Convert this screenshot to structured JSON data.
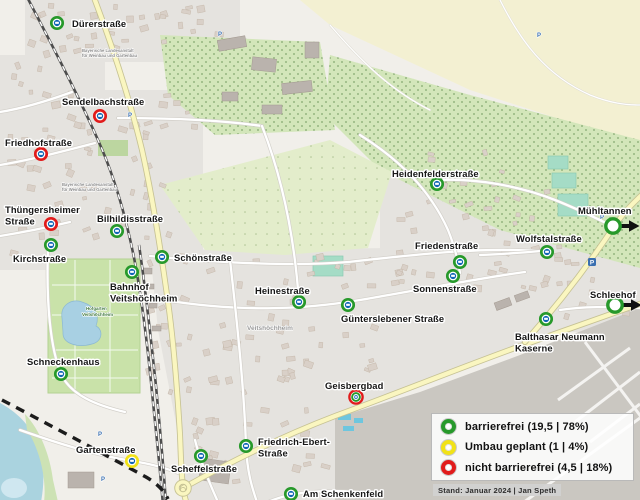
{
  "legend": {
    "items": [
      {
        "key": "barrierefrei",
        "label": "barrierefrei (19,5 | 78%)",
        "color": "#27992b"
      },
      {
        "key": "umbau_geplant",
        "label": "Umbau geplant (1 | 4%)",
        "color": "#f1e217"
      },
      {
        "key": "nicht_barrierefrei",
        "label": "nicht barrierefrei (4,5 | 18%)",
        "color": "#e11b1b"
      }
    ],
    "footnote": "Stand: Januar 2024 | Jan Speth"
  },
  "colors": {
    "barrierefrei": "#27992b",
    "umbau_geplant": "#f1e217",
    "nicht_barrierefrei": "#e11b1b",
    "bus_core": "#1065b5",
    "arrow": "#111111"
  },
  "map": {
    "stops": [
      {
        "id": "duererstrasse",
        "lines": [
          "Dürerstraße"
        ],
        "status": "barrierefrei",
        "x": 57,
        "y": 23,
        "lx": 72,
        "ly": 27
      },
      {
        "id": "sendelbachstrasse",
        "lines": [
          "Sendelbachstraße"
        ],
        "status": "nicht_barrierefrei",
        "x": 100,
        "y": 116,
        "lx": 62,
        "ly": 105
      },
      {
        "id": "friedhofstrasse",
        "lines": [
          "Friedhofstraße"
        ],
        "status": "nicht_barrierefrei",
        "x": 41,
        "y": 154,
        "lx": 5,
        "ly": 146
      },
      {
        "id": "thuengersheimer-strasse",
        "lines": [
          "Thüngersheimer",
          "Straße"
        ],
        "status": "nicht_barrierefrei",
        "x": 51,
        "y": 224,
        "lx": 5,
        "ly": 213
      },
      {
        "id": "bilhildisstrasse",
        "lines": [
          "Bilhildisstraße"
        ],
        "status": "barrierefrei",
        "x": 117,
        "y": 231,
        "lx": 97,
        "ly": 222
      },
      {
        "id": "kirchstrasse",
        "lines": [
          "Kirchstraße"
        ],
        "status": "barrierefrei",
        "x": 51,
        "y": 245,
        "lx": 13,
        "ly": 262
      },
      {
        "id": "schoenstrasse",
        "lines": [
          "Schönstraße"
        ],
        "status": "barrierefrei",
        "x": 162,
        "y": 257,
        "lx": 174,
        "ly": 261
      },
      {
        "id": "bahnhof-veitshoechheim",
        "lines": [
          "Bahnhof",
          "Veitshöchheim"
        ],
        "status": "barrierefrei",
        "x": 132,
        "y": 272,
        "lx": 110,
        "ly": 290
      },
      {
        "id": "heinestrasse",
        "lines": [
          "Heinestraße"
        ],
        "status": "barrierefrei",
        "x": 299,
        "y": 302,
        "lx": 255,
        "ly": 294
      },
      {
        "id": "schneckenhaus",
        "lines": [
          "Schneckenhaus"
        ],
        "status": "barrierefrei",
        "x": 61,
        "y": 374,
        "lx": 27,
        "ly": 365
      },
      {
        "id": "gartenstrasse",
        "lines": [
          "Gartenstraße"
        ],
        "status": "umbau_geplant",
        "x": 132,
        "y": 461,
        "lx": 76,
        "ly": 453
      },
      {
        "id": "scheffelstrasse",
        "lines": [
          "Scheffelstraße"
        ],
        "status": "barrierefrei",
        "x": 201,
        "y": 456,
        "lx": 171,
        "ly": 472
      },
      {
        "id": "friedrich-ebert-strasse",
        "lines": [
          "Friedrich-Ebert-",
          "Straße"
        ],
        "status": "barrierefrei",
        "x": 246,
        "y": 446,
        "lx": 258,
        "ly": 445
      },
      {
        "id": "am-schenkenfeld",
        "lines": [
          "Am Schenkenfeld"
        ],
        "status": "barrierefrei",
        "x": 291,
        "y": 494,
        "lx": 303,
        "ly": 497
      },
      {
        "id": "geisbergbad",
        "lines": [
          "Geisbergbad"
        ],
        "status": "teilweise_barrierefrei",
        "x": 356,
        "y": 397,
        "lx": 325,
        "ly": 389
      },
      {
        "id": "guenterslebener-strasse",
        "lines": [
          "Günterslebener Straße"
        ],
        "status": "barrierefrei",
        "x": 348,
        "y": 305,
        "lx": 341,
        "ly": 322
      },
      {
        "id": "sonnenstrasse",
        "lines": [
          "Sonnenstraße"
        ],
        "status": "barrierefrei",
        "x": 453,
        "y": 276,
        "lx": 413,
        "ly": 292
      },
      {
        "id": "friedenstrasse",
        "lines": [
          "Friedenstraße"
        ],
        "status": "barrierefrei",
        "x": 460,
        "y": 262,
        "lx": 415,
        "ly": 249
      },
      {
        "id": "wolfstalstrasse",
        "lines": [
          "Wolfstalstraße"
        ],
        "status": "barrierefrei",
        "x": 547,
        "y": 252,
        "lx": 516,
        "ly": 242
      },
      {
        "id": "balthasar-neumann-kaserne",
        "lines": [
          "Balthasar Neumann",
          "Kaserne"
        ],
        "status": "barrierefrei",
        "x": 546,
        "y": 319,
        "lx": 515,
        "ly": 340
      },
      {
        "id": "heidenfelderstrasse",
        "lines": [
          "Heidenfelderstraße"
        ],
        "status": "barrierefrei",
        "x": 437,
        "y": 184,
        "lx": 392,
        "ly": 177
      },
      {
        "id": "muehltannen",
        "lines": [
          "Mühltannen"
        ],
        "status": "barrierefrei",
        "offmap": true,
        "x": 613,
        "y": 226,
        "lx": 578,
        "ly": 214
      },
      {
        "id": "schleehof",
        "lines": [
          "Schleehof"
        ],
        "status": "barrierefrei",
        "offmap": true,
        "x": 615,
        "y": 305,
        "lx": 590,
        "ly": 298
      }
    ],
    "background_labels": [
      {
        "text": "Bayerische Landesanstalt",
        "x": 82,
        "y": 52,
        "size": 4.2,
        "color": "#8b8b8b"
      },
      {
        "text": "für Weinbau und Gartenbau",
        "x": 82,
        "y": 57,
        "size": 4.2,
        "color": "#8b8b8b"
      },
      {
        "text": "Bayerische Landesanstalt",
        "x": 62,
        "y": 186,
        "size": 4.2,
        "color": "#8b8b8b"
      },
      {
        "text": "für Weinbau und Gartenbau",
        "x": 62,
        "y": 191,
        "size": 4.2,
        "color": "#8b8b8b"
      },
      {
        "text": "Veitshöchheim",
        "x": 247,
        "y": 330,
        "size": 6.5,
        "color": "#9a9a9a"
      },
      {
        "text": "Hofgarten",
        "x": 86,
        "y": 310,
        "size": 4.4,
        "color": "#41793f"
      },
      {
        "text": "Veitshöchheim",
        "x": 82,
        "y": 316,
        "size": 4.4,
        "color": "#41793f"
      },
      {
        "text": "P",
        "x": 218,
        "y": 36,
        "size": 6,
        "color": "#3a6fb0"
      },
      {
        "text": "P",
        "x": 537,
        "y": 37,
        "size": 6,
        "color": "#3a6fb0"
      },
      {
        "text": "P",
        "x": 128,
        "y": 117,
        "size": 6,
        "color": "#3a6fb0"
      },
      {
        "text": "P",
        "x": 98,
        "y": 436,
        "size": 6,
        "color": "#3a6fb0"
      },
      {
        "text": "P",
        "x": 101,
        "y": 481,
        "size": 6,
        "color": "#3a6fb0"
      },
      {
        "text": "P",
        "x": 303,
        "y": 444,
        "size": 6,
        "color": "#3a6fb0"
      },
      {
        "text": "P",
        "x": 600,
        "y": 219,
        "size": 6,
        "color": "#3a6fb0"
      }
    ]
  }
}
